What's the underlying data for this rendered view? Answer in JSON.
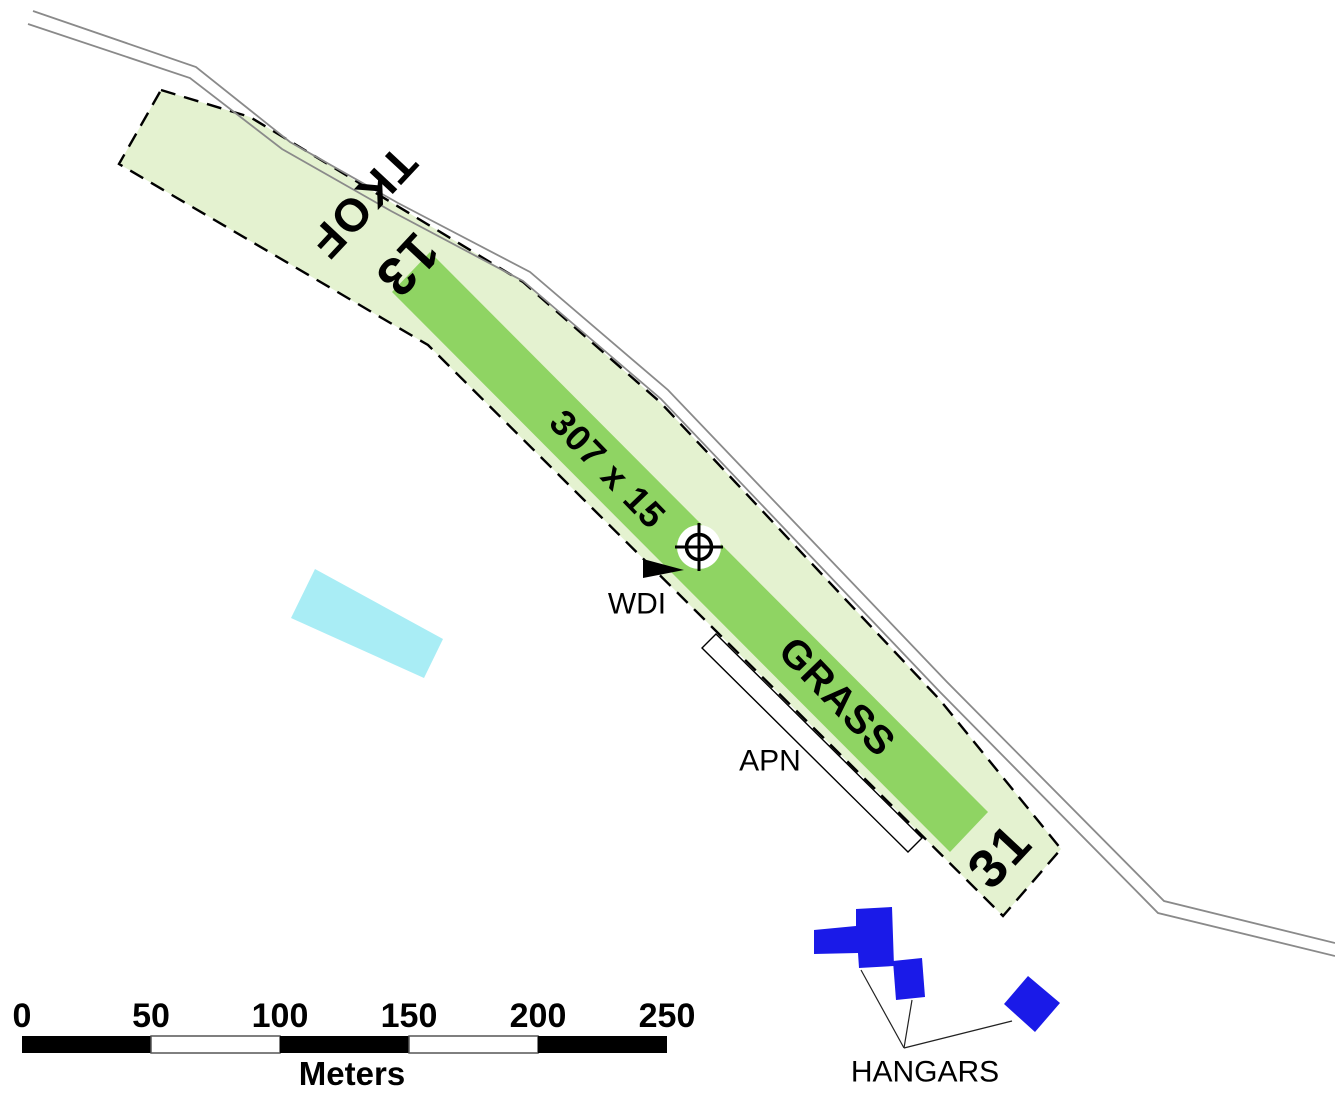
{
  "map": {
    "runway": {
      "tkof_label": "TKOF",
      "rwy13_number": "13",
      "dimensions_label": "307 x 15",
      "surface_label": "GRASS",
      "rwy31_number": "31"
    },
    "features": {
      "wdi_label": "WDI",
      "apron_label": "APN",
      "hangars_label": "HANGARS"
    },
    "symbols": {
      "arp": "aerodrome-reference-point",
      "wdi": "wind-direction-indicator"
    }
  },
  "scale_bar": {
    "ticks": [
      "0",
      "50",
      "100",
      "150",
      "200",
      "250"
    ],
    "unit_label": "Meters"
  },
  "colors": {
    "strip_green": "#E4F2D0",
    "runway_green": "#8FD463",
    "hangar_blue": "#1A1AE8",
    "building_cyan": "#A9EDF5",
    "road_gray": "#8A8A8A",
    "outline_black": "#000000",
    "apron_white": "#FFFFFF",
    "scale_black": "#000000"
  }
}
